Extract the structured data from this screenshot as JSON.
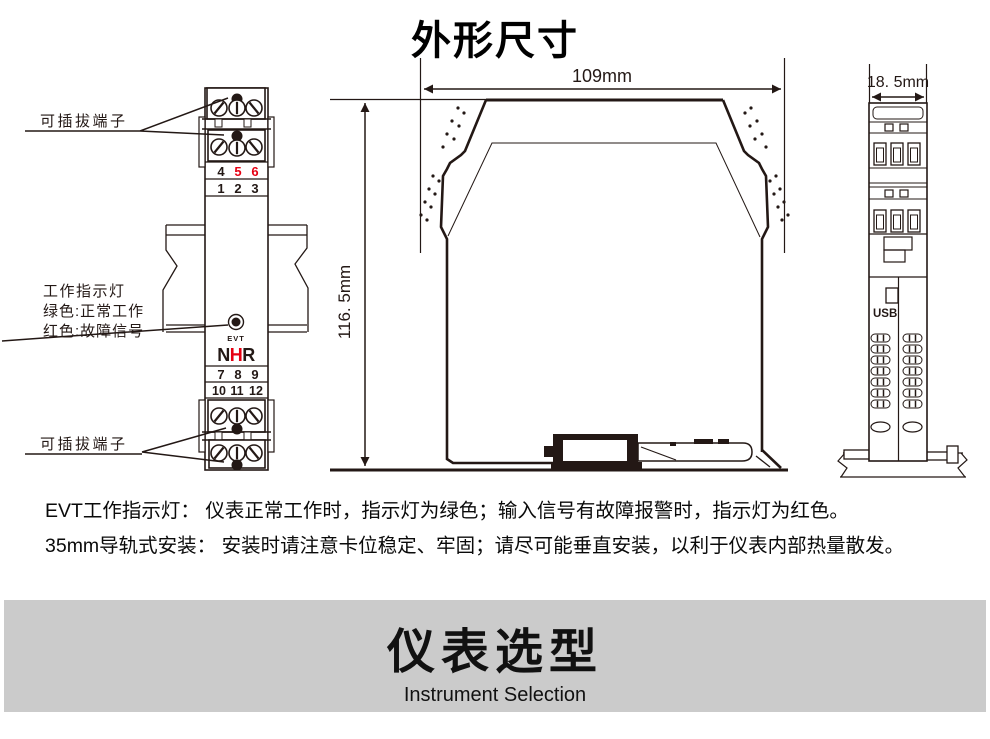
{
  "title": "外形尺寸",
  "front_view": {
    "annotation_top": "可插拔端子",
    "annotation_bottom": "可插拔端子",
    "indicator_caption": [
      "工作指示灯",
      "绿色:正常工作",
      "红色:故障信号"
    ],
    "led_label": "EVT",
    "logo": [
      "N",
      "H",
      "R"
    ],
    "terminal_rows": {
      "row_456": [
        "4",
        "5",
        "6"
      ],
      "row_123": [
        "1",
        "2",
        "3"
      ],
      "row_789": [
        "7",
        "8",
        "9"
      ],
      "row_101112": [
        "10",
        "11",
        "12"
      ]
    }
  },
  "side_view": {
    "width_label": "109mm",
    "height_label": "116. 5mm"
  },
  "profile_view": {
    "width_label": "18. 5mm",
    "usb_label": "USB"
  },
  "notes": [
    "EVT工作指示灯： 仪表正常工作时，指示灯为绿色；输入信号有故障报警时，指示灯为红色。",
    "35mm导轨式安装： 安装时请注意卡位稳定、牢固；请尽可能垂直安装，以利于仪表内部热量散发。"
  ],
  "banner": {
    "title": "仪表选型",
    "subtitle": "Instrument Selection"
  },
  "colors": {
    "ink": "#231815",
    "red": "#e60012",
    "banner_bg": "#cbcbcb"
  }
}
